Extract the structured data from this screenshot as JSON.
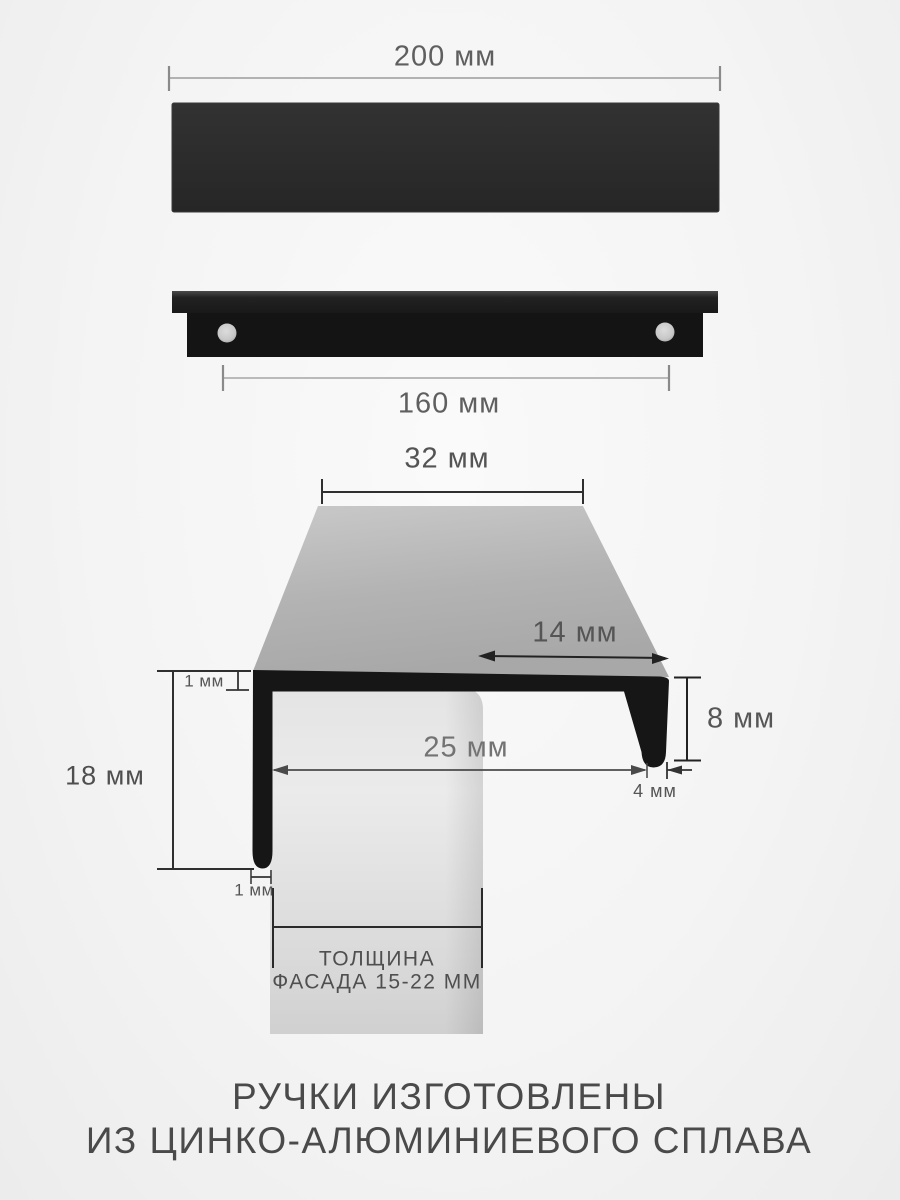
{
  "top_view": {
    "length_total": "200 мм"
  },
  "front_view": {
    "length_mounting": "160 мм"
  },
  "section_view": {
    "width_top": "32 мм",
    "overhang": "14 мм",
    "hook_height": "8 мм",
    "gap_width": "25 мм",
    "hook_thickness": "4 мм",
    "leg_height": "18 мм",
    "wall_top": "1 мм",
    "wall_leg": "1 мм",
    "facade_caption_line1": "ТОЛЩИНА",
    "facade_caption_line2": "ФАСАДА 15-22 ММ"
  },
  "caption": {
    "line1": "РУЧКИ ИЗГОТОВЛЕНЫ",
    "line2": "ИЗ ЦИНКО-АЛЮМИНИЕВОГО СПЛАВА"
  },
  "colors": {
    "handle_black": "#161616",
    "bar_black": "#2b2b2b",
    "metal_gray": "#b3b3b3",
    "facade_gray": "#e2e2e2",
    "dim_dark": "#2f2f2f",
    "dim_light": "#9c9c9c",
    "text_gray": "#5f5f5f",
    "caption_gray": "#4a4a4a",
    "background": "#f4f4f4"
  }
}
